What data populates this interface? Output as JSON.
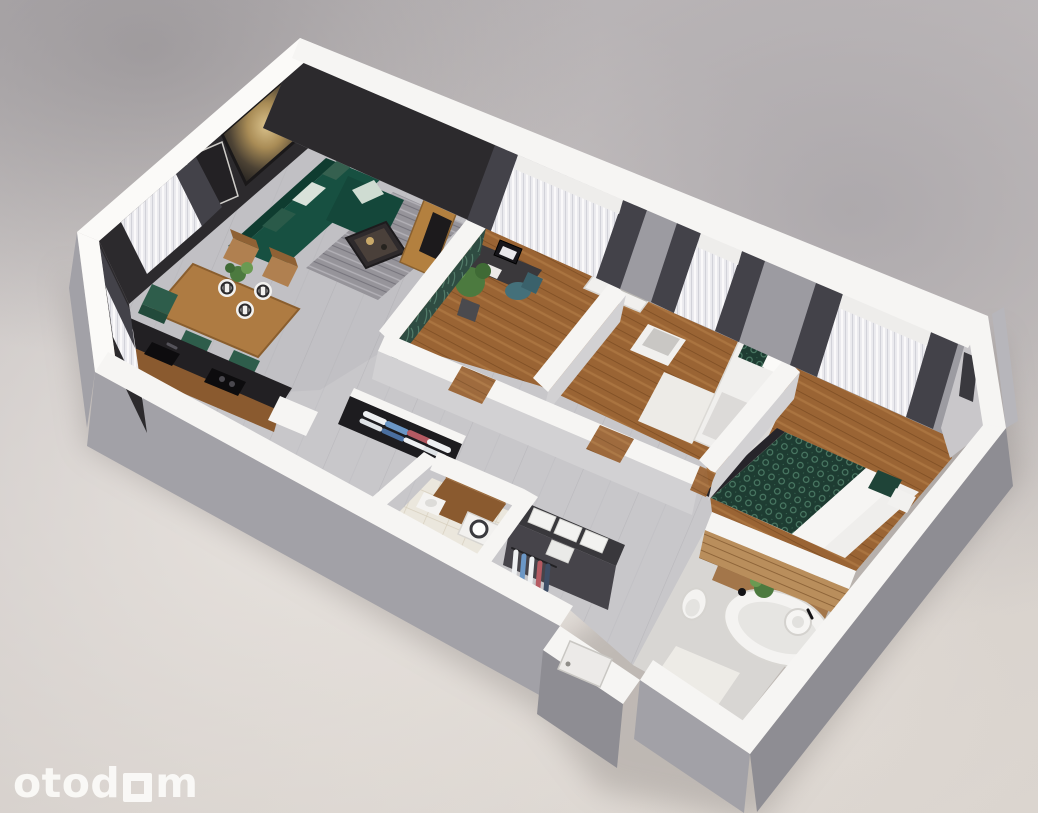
{
  "watermark": {
    "prefix": "otod",
    "suffix": "m"
  },
  "palette": {
    "wall_top": "#f6f5f3",
    "wall_top_bright": "#fbfaf8",
    "wall_outer": "#a2a1a7",
    "wall_outer_dark": "#8e8d93",
    "wall_inner_gray": "#9c9ba1",
    "wall_inner_light": "#c9c7ca",
    "partition_face": "#d2d1d3",
    "accent_wall": "#2c2a2d",
    "curtain_dark": "#434249",
    "floor_tile_base": "#c8c7ca",
    "floor_wood_base": "#9a6434",
    "rug_gray_base": "#96949a",
    "rug_white": "#edebe7",
    "sofa_green": "#175041",
    "sofa_green_dark": "#0f3c30",
    "duvet_green_base": "#1e3c32",
    "leaf_wall_base": "#2f4c42",
    "chair_teal": "#44707a",
    "chair_green": "#2e5d4b",
    "table_wood": "#ae7b42",
    "tv_panel_wood": "#b3803f",
    "kitchen_counter": "#222023",
    "cabinet_wood": "#8a5a2f",
    "slat_wood_base": "#b98e5c",
    "vanity_wood": "#a3764a",
    "bathtub_white": "#f4f3f1",
    "laundry_tile_base": "#ebe7dd",
    "wicker_base": "#c3ae8e",
    "wardrobe_dark": "#46444a",
    "door_white": "#eceae8",
    "clothes_white": "#eef0f2",
    "clothes_blue": "#6b97c6",
    "clothes_red": "#b55a62",
    "clothes_navy": "#3e4e66",
    "plant_green": "#4c7a3f",
    "plant_green_light": "#6a9a52",
    "artwork_gold": "#c9a96a",
    "sheer_base": "#ecebef",
    "shadow": "#7d7672"
  },
  "rooms": [
    {
      "name": "living-room",
      "items": [
        "sofa",
        "coffee-table",
        "area-rug",
        "artwork",
        "wall-frame",
        "dining-table",
        "dining-chairs",
        "place-settings",
        "sheer-curtains"
      ]
    },
    {
      "name": "kitchen",
      "items": [
        "countertop",
        "sink",
        "cooktop"
      ]
    },
    {
      "name": "home-office",
      "items": [
        "desk",
        "monitor",
        "office-chair",
        "potted-plant",
        "tv-panel",
        "leaf-wallpaper"
      ]
    },
    {
      "name": "second-bedroom",
      "items": [
        "bed",
        "vanity-desk",
        "bench",
        "white-rug",
        "curtains"
      ]
    },
    {
      "name": "master-bedroom",
      "items": [
        "double-bed",
        "clothes-rack",
        "curtains",
        "wall-mirror"
      ]
    },
    {
      "name": "bathroom",
      "items": [
        "bathtub",
        "vanity-board",
        "round-sink",
        "toilet",
        "plant",
        "bath-rug",
        "slat-wall"
      ]
    },
    {
      "name": "laundry",
      "items": [
        "washing-machine",
        "wood-cabinet",
        "hand-sink",
        "wicker-wall"
      ]
    },
    {
      "name": "hallway",
      "items": [
        "open-shelf-wardrobe",
        "dark-wardrobe",
        "storage-boxes",
        "entrance-door"
      ]
    }
  ]
}
